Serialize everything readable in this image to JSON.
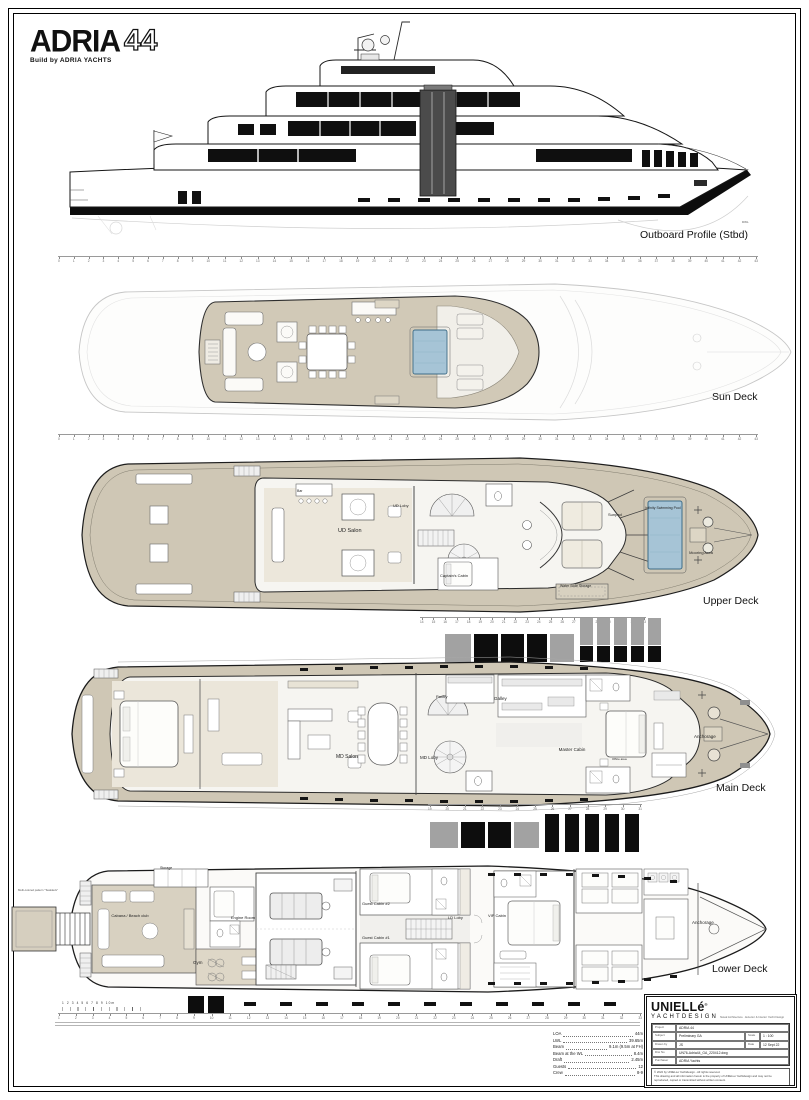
{
  "logo": {
    "brand": "ADRIA",
    "model": "44",
    "tagline": "Build by ADRIA YACHTS"
  },
  "colors": {
    "deck_beige": "#cfc7b5",
    "pool_blue": "#a6c4d6",
    "ink": "#1b1b1b"
  },
  "profile": {
    "label": "Outboard Profile (Stbd)",
    "waterline": "DWL"
  },
  "sun_deck": {
    "label": "Sun Deck"
  },
  "upper_deck": {
    "label": "Upper Deck",
    "bar": "Bar",
    "salon": "UD Salon",
    "lobby": "UD Loby",
    "wheelhouse": "Wheelhouse",
    "captain": "Captain's Cabin",
    "sunpad": "Sunpad",
    "pool": "Infinity Swimming Pool",
    "mooring": "Mooring Area",
    "slide": "Water Slide Storage"
  },
  "main_deck": {
    "label": "Main Deck",
    "pantry": "Pantry",
    "galley": "Galley",
    "salon": "MD Salon",
    "lobby": "MD Loby",
    "master": "Master Cabin",
    "office": "Office area",
    "anchorage": "Anchorage"
  },
  "lower_deck": {
    "label": "Lower Deck",
    "storage": "Storage",
    "cabana": "Cabana / Beach club",
    "engine": "Engine Room",
    "gym": "Gym",
    "guest2": "Guest Cabin #2",
    "guest1": "Guest Cabin #1",
    "lobby": "LD Loby",
    "vip": "VIP Cabin",
    "anchorage": "Anchorage",
    "note": "Multi-colored pattern \"Teakdeck\""
  },
  "specs": {
    "items": [
      {
        "label": "LOA",
        "value": "44m"
      },
      {
        "label": "LWL",
        "value": "39.65m"
      },
      {
        "label": "Beam",
        "value": "9.1m (9.5m at FH)"
      },
      {
        "label": "Beam at the WL",
        "value": "8.4m"
      },
      {
        "label": "Draft",
        "value": "2.45m"
      },
      {
        "label": "Guests",
        "value": "12"
      },
      {
        "label": "Crew",
        "value": "8-9"
      }
    ]
  },
  "scale_bar": {
    "label": "1 2 3 4 5 6 7 8 9 10m"
  },
  "title_block": {
    "company": "UNIELLé",
    "reg": "®",
    "company2": "YACHTDESIGN",
    "address": "Naval Architecture · Exterior & Interior Yacht Design",
    "project_label": "Project",
    "project": "ADRIA 44",
    "subject_label": "Subject",
    "subject": "Preliminary GA",
    "scale_label": "Scale",
    "scale": "1 : 100",
    "drawn_label": "Drawn by",
    "drawn": "JS",
    "date_label": "Date",
    "date": "12 Sept 22",
    "dwg_label": "Drw No",
    "dwg": "UN76-Adria44_GA_220412.dwg",
    "purchaser_label": "Purchaser",
    "purchaser": "ADRIA Yachts",
    "footnote1": "© 2022 by UNIELLé Yachtdesign - All rights reserved.",
    "footnote2": "This drawing and all information herein is the property of UNIELLé Yachtdesign and may not be reproduced, copied or transmitted without written consent."
  },
  "rulers": {
    "full": [
      "0",
      "1",
      "2",
      "3",
      "4",
      "5",
      "6",
      "7",
      "8",
      "9",
      "10",
      "11",
      "12",
      "13",
      "14",
      "15",
      "16",
      "17",
      "18",
      "19",
      "20",
      "21",
      "22",
      "23",
      "24",
      "25",
      "26",
      "27",
      "28",
      "29",
      "30",
      "31",
      "32",
      "33",
      "34",
      "35",
      "36",
      "37",
      "38",
      "39",
      "40",
      "41",
      "42",
      "43"
    ],
    "midA": [
      "14",
      "15",
      "16",
      "17",
      "18",
      "19",
      "20",
      "21",
      "22",
      "23",
      "24",
      "25",
      "26",
      "27",
      "28",
      "29",
      "30",
      "31",
      "32",
      "33"
    ],
    "midB": [
      "19",
      "20",
      "21",
      "22",
      "23",
      "24",
      "25",
      "26",
      "27",
      "28",
      "29",
      "30",
      "31"
    ],
    "bottom": [
      "1",
      "2",
      "3",
      "4",
      "5",
      "6",
      "7",
      "8",
      "9",
      "10",
      "11",
      "12",
      "13",
      "14",
      "15",
      "16",
      "17",
      "18",
      "19",
      "20",
      "21",
      "22",
      "23",
      "24",
      "25",
      "26",
      "27",
      "28",
      "29",
      "30",
      "31",
      "32",
      "33"
    ]
  }
}
